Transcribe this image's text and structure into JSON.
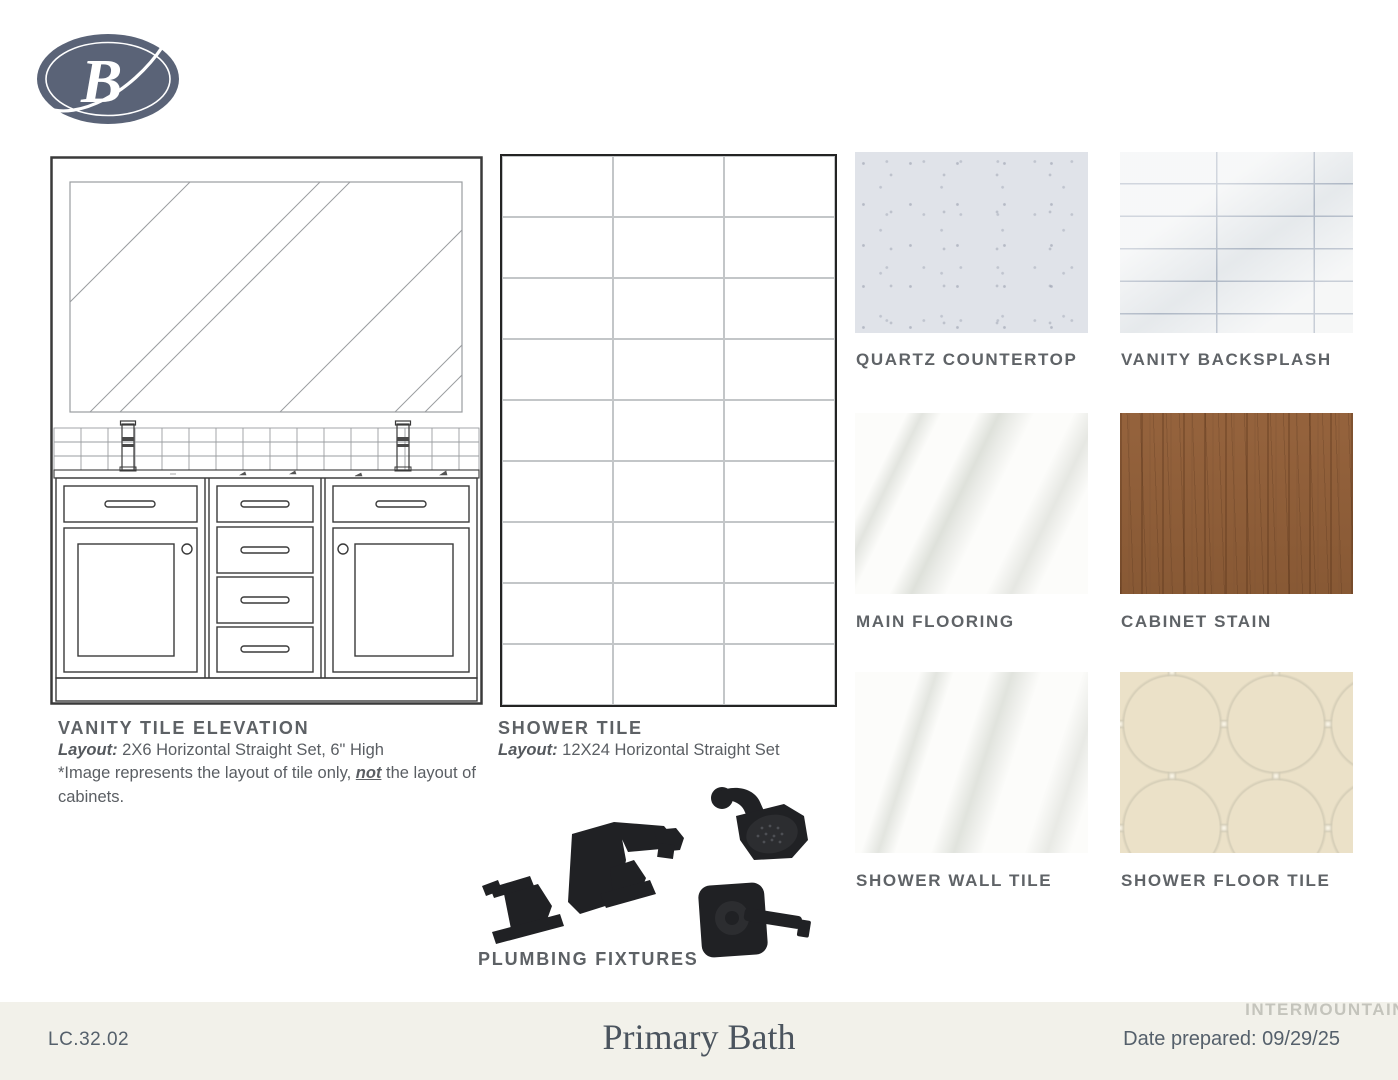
{
  "logo": {
    "letter": "B"
  },
  "vanity": {
    "title": "VANITY TILE ELEVATION",
    "layout_label": "Layout:",
    "layout_value": " 2X6 Horizontal Straight Set, 6\" High",
    "note_before": "*Image represents the layout of tile only, ",
    "note_bold": "not",
    "note_after": " the layout of cabinets."
  },
  "shower": {
    "title": "SHOWER TILE",
    "layout_label": "Layout:",
    "layout_value": " 12X24 Horizontal Straight Set",
    "grid_rows": 9,
    "grid_columns": 3
  },
  "plumbing": {
    "label": "PLUMBING FIXTURES"
  },
  "swatches": [
    {
      "id": "quartz-countertop",
      "label": "QUARTZ COUNTERTOP",
      "color": "#e0e3e9"
    },
    {
      "id": "vanity-backsplash",
      "label": "VANITY BACKSPLASH",
      "color": "#eef0f1"
    },
    {
      "id": "main-flooring",
      "label": "MAIN FLOORING",
      "color": "#fcfcfa"
    },
    {
      "id": "cabinet-stain",
      "label": "CABINET STAIN",
      "color": "#99663f"
    },
    {
      "id": "shower-wall-tile",
      "label": "SHOWER WALL TILE",
      "color": "#fcfcfa"
    },
    {
      "id": "shower-floor-tile",
      "label": "SHOWER FLOOR TILE",
      "color": "#f7f2e3"
    }
  ],
  "footer": {
    "doc_code": "LC.32.02",
    "title": "Primary Bath",
    "date_label": "Date prepared:",
    "date_value": " 09/29/25",
    "watermark": "INTERMOUNTAIN"
  },
  "colors": {
    "logo_slate": "#5a6377",
    "heading_gray": "#5d6165",
    "body_gray": "#5a5e63",
    "footer_bg": "#f2f1ea",
    "fixture_black": "#202124",
    "grout_blue_gray": "#9aa5b6",
    "drawing_line_dark": "#3a3a3a",
    "drawing_line_light": "#9a9da0"
  }
}
